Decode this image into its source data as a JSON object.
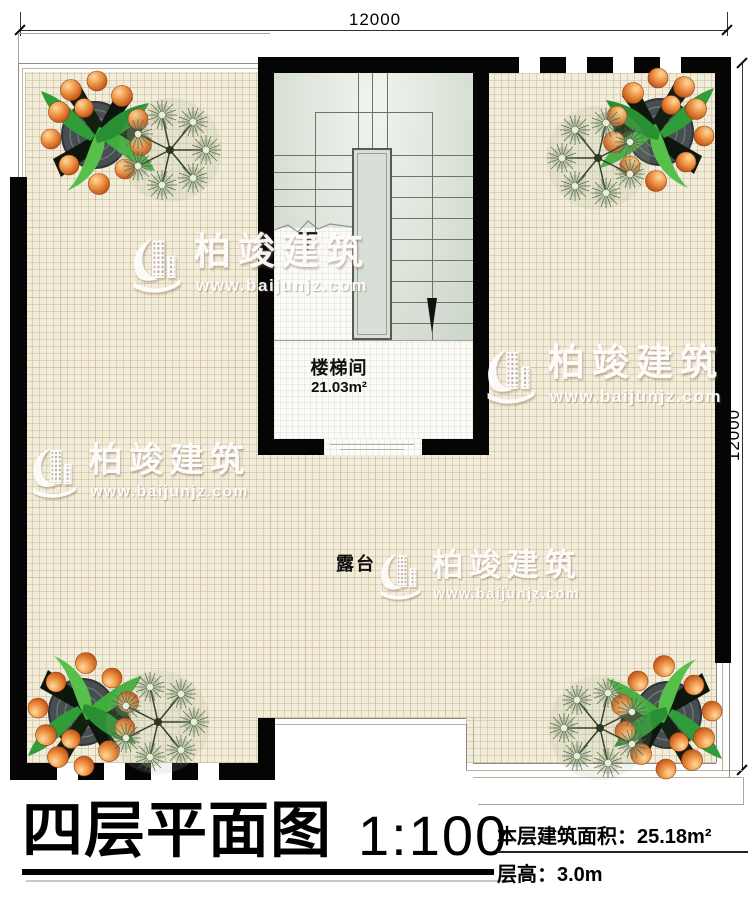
{
  "dimensions": {
    "top_width": "12000",
    "right_height": "12000"
  },
  "rooms": {
    "terrace": {
      "label": "露台"
    },
    "stairwell": {
      "label": "楼梯间",
      "area": "21.03m²",
      "direction": "下"
    }
  },
  "watermark": {
    "brand": "柏竣建筑",
    "website": "www.baijunjz.com"
  },
  "title_block": {
    "drawing_title": "四层平面图",
    "scale": "1:100",
    "floor_area": "本层建筑面积：25.18m²",
    "floor_height": "层高：3.0m"
  },
  "colors": {
    "wall": "#050505",
    "terrace_floor": "#f1edda",
    "grid_line": "#baa67c",
    "stair_floor": "#dde4da",
    "tile_floor": "#fbfbf7",
    "fruit_orange": "#e07a38",
    "leaf_green": "#3a9e3f",
    "watermark_white": "#ffffff"
  }
}
